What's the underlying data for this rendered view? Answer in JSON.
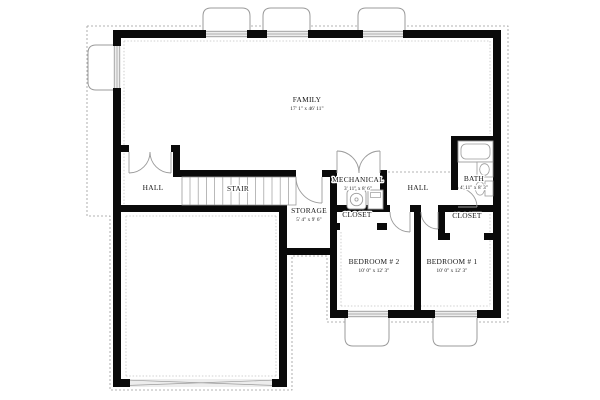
{
  "plan": {
    "type": "floor-plan",
    "colors": {
      "wall": "#0a0a0a",
      "line": "#9b9b9b",
      "faint": "#c3c3c3",
      "window_fill": "#ededed",
      "text": "#161616",
      "background": "#ffffff"
    },
    "rooms": [
      {
        "id": "family",
        "label": "FAMILY",
        "dim": "17' 1\" x 46' 11\"",
        "x": 307,
        "y": 102
      },
      {
        "id": "hall-left",
        "label": "HALL",
        "x": 153,
        "y": 190
      },
      {
        "id": "stair",
        "label": "STAIR",
        "x": 238,
        "y": 191
      },
      {
        "id": "storage",
        "label": "STORAGE",
        "dim": "5' 4\" x 9' 6\"",
        "x": 309,
        "y": 213
      },
      {
        "id": "mechanical",
        "label": "MECHANICAL",
        "dim": "3' 11\" x 8' 6\"",
        "x": 358,
        "y": 182
      },
      {
        "id": "closet-mechanical",
        "label": "CLOSET",
        "x": 357,
        "y": 217
      },
      {
        "id": "hall-right",
        "label": "HALL",
        "x": 418,
        "y": 190
      },
      {
        "id": "bath",
        "label": "BATH",
        "dim": "4' 11\" x 8' 3\"",
        "x": 474,
        "y": 181
      },
      {
        "id": "closet-right",
        "label": "CLOSET",
        "x": 467,
        "y": 218
      },
      {
        "id": "bedroom-2",
        "label": "BEDROOM # 2",
        "dim": "10' 0\" x 12' 3\"",
        "x": 374,
        "y": 264
      },
      {
        "id": "bedroom-1",
        "label": "BEDROOM # 1",
        "dim": "10' 0\" x 12' 3\"",
        "x": 452,
        "y": 264
      }
    ],
    "walls": [
      [
        113,
        30,
        388,
        8
      ],
      [
        113,
        30,
        8,
        357
      ],
      [
        493,
        30,
        8,
        288
      ],
      [
        330,
        310,
        171,
        8
      ],
      [
        113,
        379,
        174,
        8
      ],
      [
        279,
        205,
        8,
        182
      ],
      [
        113,
        205,
        174,
        7
      ],
      [
        121,
        145,
        8,
        7
      ],
      [
        171,
        145,
        9,
        7
      ],
      [
        173,
        145,
        7,
        32
      ],
      [
        180,
        170,
        116,
        7
      ],
      [
        322,
        170,
        15,
        7
      ],
      [
        330,
        170,
        7,
        148
      ],
      [
        380,
        170,
        7,
        42
      ],
      [
        330,
        205,
        60,
        7
      ],
      [
        410,
        205,
        11,
        7
      ],
      [
        414,
        205,
        7,
        113
      ],
      [
        438,
        205,
        7,
        35
      ],
      [
        438,
        205,
        63,
        7
      ],
      [
        438,
        233,
        12,
        7
      ],
      [
        484,
        233,
        17,
        7
      ],
      [
        451,
        136,
        7,
        54
      ],
      [
        451,
        136,
        50,
        7
      ],
      [
        330,
        223,
        10,
        7
      ],
      [
        377,
        223,
        10,
        7
      ],
      [
        287,
        248,
        50,
        7
      ]
    ],
    "windows": [
      {
        "r": [
          206,
          30,
          41,
          8
        ],
        "o": "h"
      },
      {
        "r": [
          267,
          30,
          41,
          8
        ],
        "o": "h"
      },
      {
        "r": [
          363,
          30,
          40,
          8
        ],
        "o": "h"
      },
      {
        "r": [
          113,
          46,
          8,
          42
        ],
        "o": "v"
      },
      {
        "r": [
          348,
          310,
          40,
          8
        ],
        "o": "h"
      },
      {
        "r": [
          435,
          310,
          42,
          8
        ],
        "o": "h"
      }
    ],
    "window_wells": [
      "M 203,33 L 203,16 Q 203,8 211,8 L 242,8 Q 250,8 250,16 L 250,33",
      "M 263,33 L 263,16 Q 263,8 271,8 L 302,8 Q 310,8 310,16 L 310,33",
      "M 358,33 L 358,16 Q 358,8 366,8 L 397,8 Q 405,8 405,16 L 405,33",
      "M 114,45 L 96,45 Q 88,45 88,53 L 88,82 Q 88,90 96,90 L 114,90",
      "M 345,317 L 345,338 Q 345,346 353,346 L 381,346 Q 389,346 389,338 L 389,317",
      "M 433,317 L 433,338 Q 433,346 441,346 L 469,346 Q 477,346 477,338 L 477,317"
    ],
    "boundary_points": "87,26 508,26 508,322 327,322 327,256 292,256 292,390 110,390 110,216 87,216 87,26",
    "insulation_segments": [
      [
        124,
        41,
        490,
        41
      ],
      [
        124,
        41,
        124,
        204
      ],
      [
        490,
        41,
        490,
        134
      ],
      [
        490,
        214,
        490,
        306
      ],
      [
        341,
        306,
        490,
        306
      ],
      [
        341,
        232,
        341,
        306
      ],
      [
        126,
        216,
        276,
        216
      ],
      [
        276,
        216,
        276,
        376
      ],
      [
        126,
        376,
        276,
        376
      ],
      [
        126,
        216,
        126,
        376
      ]
    ],
    "open_dash": [
      388,
      172,
      451,
      172
    ],
    "stair": {
      "frame": [
        182,
        177,
        114,
        28
      ],
      "tread_start": 190,
      "tread_step": 8.2,
      "tread_count": 13
    },
    "garage_door": {
      "rect": [
        130,
        379,
        142,
        8
      ],
      "cross": [
        [
          130,
          380.2,
          272,
          385.4
        ],
        [
          130,
          385.4,
          272,
          380.2
        ]
      ]
    },
    "doors": [
      {
        "id": "door-storage-landing",
        "path": "M 296,177 A 26 26 0 0 0 322,203",
        "leaf": [
          322,
          177,
          322,
          203
        ]
      },
      {
        "id": "door-hall-double-left",
        "path": "M 129,173 A 21 21 0 0 0 150,152",
        "leaf": [
          129,
          152,
          129,
          173
        ]
      },
      {
        "id": "door-hall-double-right",
        "path": "M 171,173 A 21 21 0 0 1 150,152",
        "leaf": [
          171,
          152,
          171,
          173
        ]
      },
      {
        "id": "door-mech-double-left",
        "path": "M 337,151 A 22 22 0 0 1 359,173",
        "leaf": [
          337,
          173,
          337,
          151
        ]
      },
      {
        "id": "door-mech-double-right",
        "path": "M 380,151 A 21 21 0 0 0 359,173",
        "leaf": [
          380,
          173,
          380,
          151
        ]
      },
      {
        "id": "door-bath",
        "path": "M 477,207 A 19 19 0 0 0 458,188",
        "leaf": [
          458,
          207,
          477,
          207
        ]
      },
      {
        "id": "door-bedroom-2",
        "path": "M 390,212 A 20 20 0 0 0 410,232",
        "leaf": [
          410,
          212,
          410,
          232
        ]
      },
      {
        "id": "door-bedroom-1",
        "path": "M 421,212 A 17 17 0 0 0 438,229",
        "leaf": [
          438,
          212,
          438,
          229
        ]
      }
    ],
    "fixtures": {
      "water_heater": {
        "box": [
          347,
          190,
          19,
          19
        ],
        "circle": [
          356.5,
          199.5,
          6.2
        ],
        "dot": [
          356.5,
          199.5,
          1.6
        ]
      },
      "furnace": {
        "box": [
          368,
          190,
          15,
          19
        ],
        "inner": [
          370.5,
          192.5,
          10,
          5
        ]
      },
      "tub": {
        "outer": [
          458,
          141,
          35,
          21
        ],
        "inner": [
          461,
          144,
          29,
          15
        ]
      },
      "sink": {
        "counter": [
          477,
          162,
          16,
          15
        ],
        "basin": [
          484.5,
          169.5,
          4.8,
          5.8
        ]
      },
      "toilet": {
        "tank": [
          485,
          181,
          8,
          15
        ],
        "bowl": [
          480,
          188.5,
          4.6,
          6.6
        ]
      }
    }
  }
}
